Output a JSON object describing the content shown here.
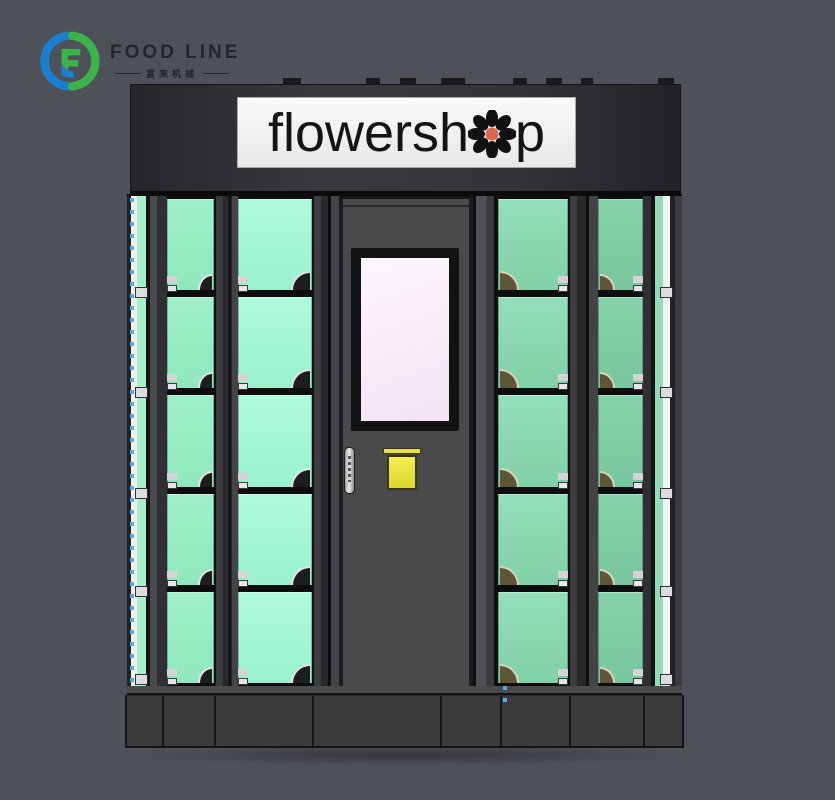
{
  "scene": {
    "background_color": "#4e5158"
  },
  "brand": {
    "name": "FOOD LINE",
    "subtext": "富来机械",
    "logo_green": "#3cb24b",
    "logo_blue": "#1b7fd1",
    "text_color": "#23262b"
  },
  "sign": {
    "text_left": "flowersh",
    "text_right": "p",
    "flower_petal_color": "#111111",
    "flower_center_color": "#d96a4e",
    "background": "#f5f3f4",
    "text_color": "#141414"
  },
  "machine": {
    "locker_rows": 5,
    "locker_columns_left": 2,
    "locker_columns_right": 2,
    "header_color": "#2e2e31",
    "left_glass_color": "#a4f6d6",
    "right_glass_color": "#80d1a7",
    "door_color": "#48484a",
    "screen_color": "#f8eef8",
    "button_color": "#e8e43c",
    "led_dot_color": "#57a9de",
    "base_color": "#3c3c3f"
  }
}
